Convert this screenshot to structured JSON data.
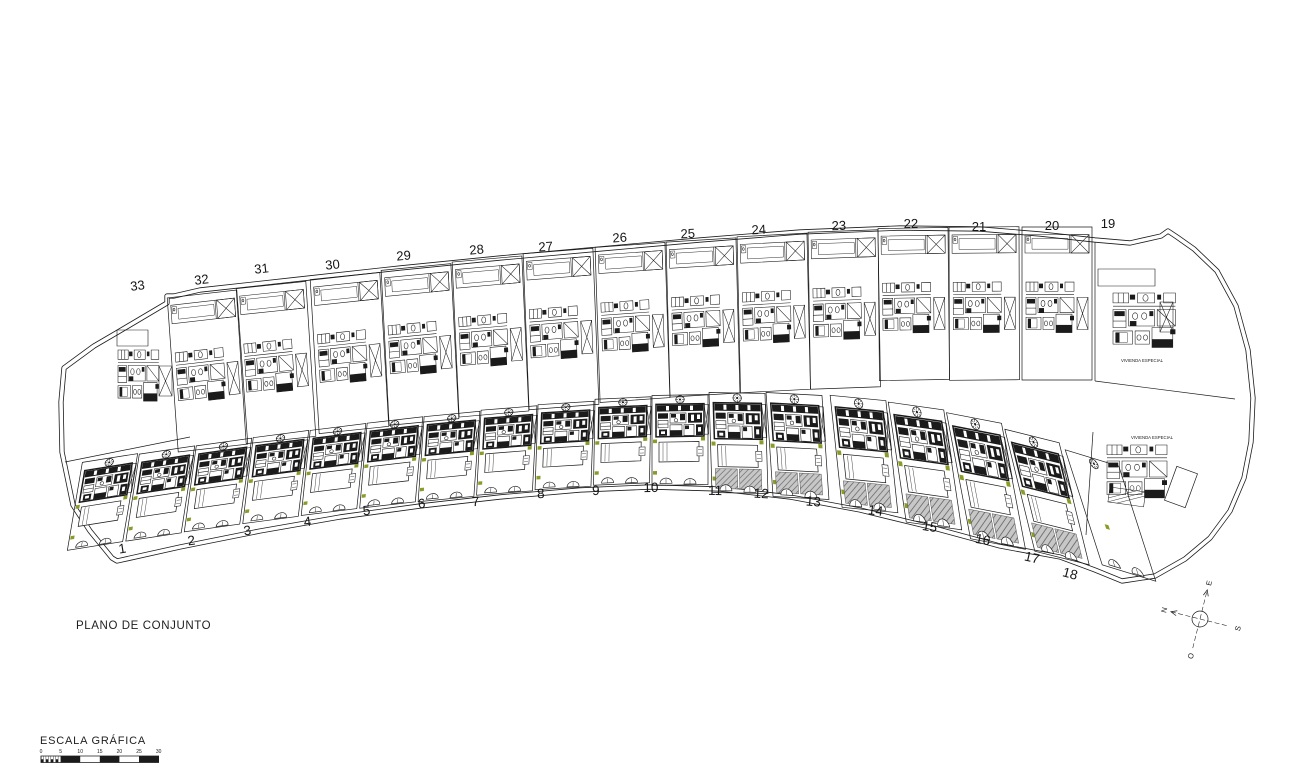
{
  "texts": {
    "title": "PLANO DE CONJUNTO",
    "scale_label": "ESCALA GRÁFICA",
    "special_dwelling": "VIVIENDA ESPECIAL"
  },
  "colors": {
    "line": "#1b1b1b",
    "green": "#8a9b28",
    "hatch_bg": "#c7c7c7",
    "hatch_line": "#6e6e6e",
    "paper": "#ffffff"
  },
  "scale_bar": {
    "ticks": [
      0,
      5,
      10,
      15,
      20,
      25,
      30
    ],
    "x0": 41,
    "per5": 19.6,
    "bar_y": 756,
    "bar_h": 6.5
  },
  "compass": {
    "cx": 1200,
    "cy": 619,
    "rotation": -76,
    "labels": {
      "n": "N",
      "e": "E",
      "s": "S",
      "o": "O"
    }
  },
  "site": {
    "outer": [
      [
        174,
        296
      ],
      [
        167,
        296
      ],
      [
        167,
        303
      ],
      [
        118,
        332
      ],
      [
        94,
        346
      ],
      [
        64,
        368
      ],
      [
        61,
        402
      ],
      [
        62,
        452
      ],
      [
        73,
        505
      ],
      [
        90,
        531
      ],
      [
        112,
        558
      ],
      [
        117,
        561
      ],
      [
        180,
        547
      ],
      [
        260,
        531
      ],
      [
        340,
        517
      ],
      [
        420,
        506
      ],
      [
        500,
        497
      ],
      [
        580,
        490
      ],
      [
        650,
        487
      ],
      [
        720,
        489
      ],
      [
        790,
        497
      ],
      [
        860,
        510
      ],
      [
        930,
        527
      ],
      [
        1000,
        546
      ],
      [
        1060,
        557
      ],
      [
        1095,
        570
      ],
      [
        1122,
        581
      ],
      [
        1155,
        576
      ],
      [
        1185,
        559
      ],
      [
        1210,
        538
      ],
      [
        1230,
        511
      ],
      [
        1244,
        478
      ],
      [
        1251,
        442
      ],
      [
        1253,
        398
      ],
      [
        1248,
        350
      ],
      [
        1236,
        306
      ],
      [
        1217,
        271
      ],
      [
        1194,
        249
      ],
      [
        1177,
        237
      ],
      [
        1168,
        231
      ],
      [
        1161,
        236
      ],
      [
        1130,
        243
      ],
      [
        1095,
        240
      ],
      [
        1040,
        234
      ],
      [
        980,
        229
      ],
      [
        900,
        228
      ],
      [
        800,
        232
      ],
      [
        700,
        240
      ],
      [
        600,
        249
      ],
      [
        500,
        258
      ],
      [
        400,
        268
      ],
      [
        300,
        279
      ],
      [
        200,
        290
      ],
      [
        174,
        296
      ]
    ]
  },
  "plots": {
    "top": [
      [
        32,
        202,
        294,
        -6.5,
        0.11,
        154
      ],
      [
        31,
        271,
        285,
        -6,
        0.1,
        155
      ],
      [
        30,
        345,
        276,
        -6,
        0.09,
        154
      ],
      [
        29,
        416,
        267,
        -5.5,
        0.08,
        155
      ],
      [
        28,
        487,
        259,
        -5,
        0.07,
        155
      ],
      [
        27,
        558,
        251,
        -4.5,
        0.06,
        156
      ],
      [
        26,
        630,
        245,
        -4,
        0.05,
        155
      ],
      [
        25,
        701,
        240,
        -3.5,
        0.04,
        155
      ],
      [
        24,
        772,
        235,
        -3,
        0.035,
        156
      ],
      [
        23,
        843,
        231,
        -2,
        0.025,
        157
      ],
      [
        22,
        913,
        228,
        -1,
        0.015,
        152
      ],
      [
        21,
        984,
        227,
        -0.5,
        0.005,
        153
      ],
      [
        20,
        1057,
        227,
        0,
        0,
        153
      ]
    ],
    "top_labels": [
      [
        33,
        138,
        290,
        -7
      ],
      [
        32,
        202,
        284,
        -7
      ],
      [
        31,
        262,
        273,
        -6
      ],
      [
        30,
        333,
        269,
        -6
      ],
      [
        29,
        404,
        260,
        -5
      ],
      [
        28,
        477,
        254,
        -5
      ],
      [
        27,
        546,
        251,
        -4
      ],
      [
        26,
        620,
        242,
        -4
      ],
      [
        25,
        688,
        238,
        -3
      ],
      [
        24,
        759,
        234,
        -3
      ],
      [
        23,
        839,
        230,
        -2
      ],
      [
        22,
        911,
        228,
        -1
      ],
      [
        21,
        979,
        231,
        0
      ],
      [
        20,
        1052,
        230,
        0
      ],
      [
        19,
        1108,
        228,
        0
      ]
    ],
    "bottom": [
      [
        1,
        110,
        458,
        -9,
        -0.15,
        88,
        1,
        0
      ],
      [
        2,
        167,
        450,
        -8.5,
        -0.135,
        87,
        1,
        0
      ],
      [
        3,
        224,
        442,
        -8,
        -0.12,
        86,
        1,
        0
      ],
      [
        4,
        281,
        434,
        -7.5,
        -0.105,
        86,
        1,
        0
      ],
      [
        5,
        338,
        427,
        -7,
        -0.09,
        85,
        1,
        0
      ],
      [
        6,
        395,
        420,
        -6.5,
        -0.075,
        85,
        1,
        0
      ],
      [
        7,
        452,
        414,
        -5.5,
        -0.06,
        85,
        1,
        0
      ],
      [
        8,
        509,
        408,
        -4.5,
        -0.045,
        85,
        1,
        0
      ],
      [
        9,
        566,
        403,
        -3.5,
        -0.03,
        85,
        1,
        0
      ],
      [
        10,
        623,
        398,
        -2.5,
        -0.015,
        86,
        1,
        0
      ],
      [
        11,
        680,
        395,
        -1,
        0,
        90,
        1,
        0
      ],
      [
        12,
        737,
        393,
        1,
        0.03,
        100,
        1,
        1
      ],
      [
        13,
        794,
        394,
        3,
        0.07,
        104,
        1,
        1
      ],
      [
        14,
        858,
        398,
        5.5,
        0.12,
        112,
        1,
        1
      ],
      [
        15,
        916,
        406,
        8,
        0.18,
        120,
        1,
        1
      ],
      [
        16,
        974,
        418,
        11,
        0.24,
        126,
        1,
        1
      ],
      [
        17,
        1032,
        436,
        14,
        0.3,
        122,
        1,
        1
      ],
      [
        18,
        1092,
        458,
        17,
        0.37,
        115,
        0,
        0
      ]
    ],
    "bottom_labels": [
      [
        1,
        123,
        553,
        -9
      ],
      [
        2,
        192,
        545,
        -8
      ],
      [
        3,
        248,
        535,
        -8
      ],
      [
        4,
        308,
        526,
        -7
      ],
      [
        5,
        367,
        515,
        -6
      ],
      [
        6,
        422,
        508,
        -5
      ],
      [
        7,
        476,
        506,
        -4
      ],
      [
        8,
        541,
        498,
        -3
      ],
      [
        9,
        596,
        495,
        -2
      ],
      [
        10,
        651,
        492,
        -1
      ],
      [
        11,
        715,
        495,
        1
      ],
      [
        12,
        761,
        498,
        3
      ],
      [
        13,
        813,
        506,
        5
      ],
      [
        14,
        875,
        515,
        7
      ],
      [
        15,
        929,
        531,
        9
      ],
      [
        16,
        982,
        544,
        11
      ],
      [
        17,
        1031,
        562,
        13
      ],
      [
        18,
        1069,
        578,
        15
      ]
    ]
  },
  "specials": {
    "plot33": {
      "bottom_line": [
        65,
        462,
        190,
        437
      ],
      "pad_rect": [
        117,
        330,
        31,
        16
      ],
      "house": [
        118,
        350,
        0.85,
        1.55
      ],
      "xrect": [
        159,
        366,
        13,
        30
      ]
    },
    "plot19": {
      "divider": [
        1095,
        242,
        1095,
        381
      ],
      "diag": [
        1095,
        381,
        1235,
        399
      ],
      "pad_rect": [
        1098,
        269,
        57,
        17
      ],
      "house": [
        1113,
        293,
        1.3,
        1.65
      ],
      "label_x": 1142,
      "label_y": 362
    },
    "special_area": {
      "left_line": [
        1093,
        432,
        1086,
        535
      ],
      "label_x": 1152,
      "label_y": 439,
      "house": [
        1107,
        445,
        1.25,
        1.6
      ],
      "hatch_rect": [
        1110,
        487,
        36,
        15,
        8
      ],
      "pool": [
        1181,
        487,
        22,
        36,
        20
      ]
    }
  }
}
